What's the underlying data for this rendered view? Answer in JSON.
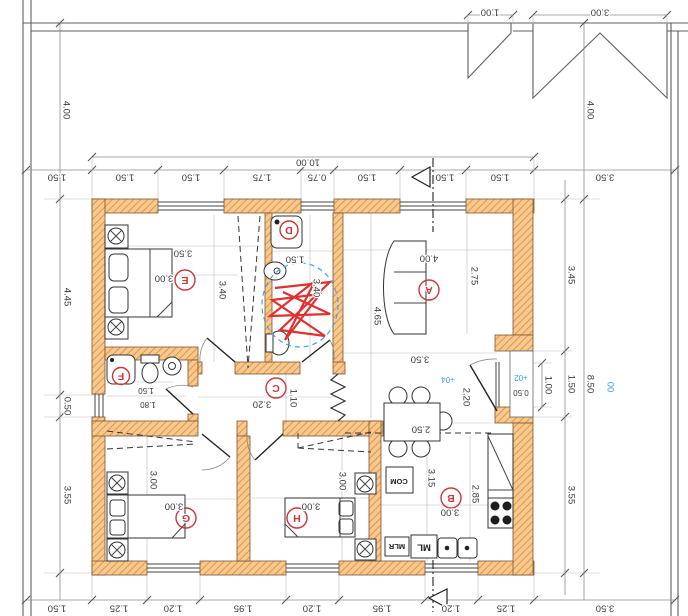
{
  "site": {
    "canopy_small": "1.00",
    "canopy_large": "3.00",
    "top_left": "4.00",
    "top_right": "4.00",
    "left": "1.50",
    "right": "3.50",
    "bottom_left": "1.50",
    "bottom_right": "3.50"
  },
  "overall": {
    "width": "10.00",
    "height": "8.50",
    "datum": "00"
  },
  "top_row": [
    "1.50",
    "1.50",
    "1.75",
    "0.75",
    "1.50",
    "1.50",
    "1.50"
  ],
  "bottom_row": [
    "1.25",
    "1.20",
    "1.95",
    "1.20",
    "1.95",
    "1.20",
    "1.25"
  ],
  "left_col": [
    "4.45",
    "0.50",
    "3.55"
  ],
  "right_col": [
    "3.45",
    "1.50",
    "3.55"
  ],
  "entry": {
    "opening": "1.00",
    "clear": "2.20",
    "floor_level": "+04",
    "step_level": "+02",
    "step_width": "0.50"
  },
  "rooms": {
    "A": {
      "letter": "A",
      "width": "4.00",
      "depth": "4.65",
      "sofa_zone": "2.75",
      "lower_width": "3.50"
    },
    "B": {
      "letter": "B",
      "width": "3.00",
      "depth": "3.15",
      "inner_depth": "2.85",
      "table": "2.50"
    },
    "C": {
      "letter": "C",
      "width": "3.20",
      "height": "1.10"
    },
    "D": {
      "letter": "D",
      "width": "1.50",
      "depth": "3.40"
    },
    "E": {
      "letter": "E",
      "width": "3.50",
      "bed_zone": "3.00",
      "depth": "3.40"
    },
    "F": {
      "letter": "F",
      "width": "1.50",
      "width_full": "1.80"
    },
    "G": {
      "letter": "G",
      "width": "3.00",
      "depth": "3.00"
    },
    "H": {
      "letter": "H",
      "width": "3.00",
      "depth": "3.00"
    }
  },
  "kitchen": {
    "com": "COM",
    "ml": "ML",
    "mlr": "MLR"
  }
}
